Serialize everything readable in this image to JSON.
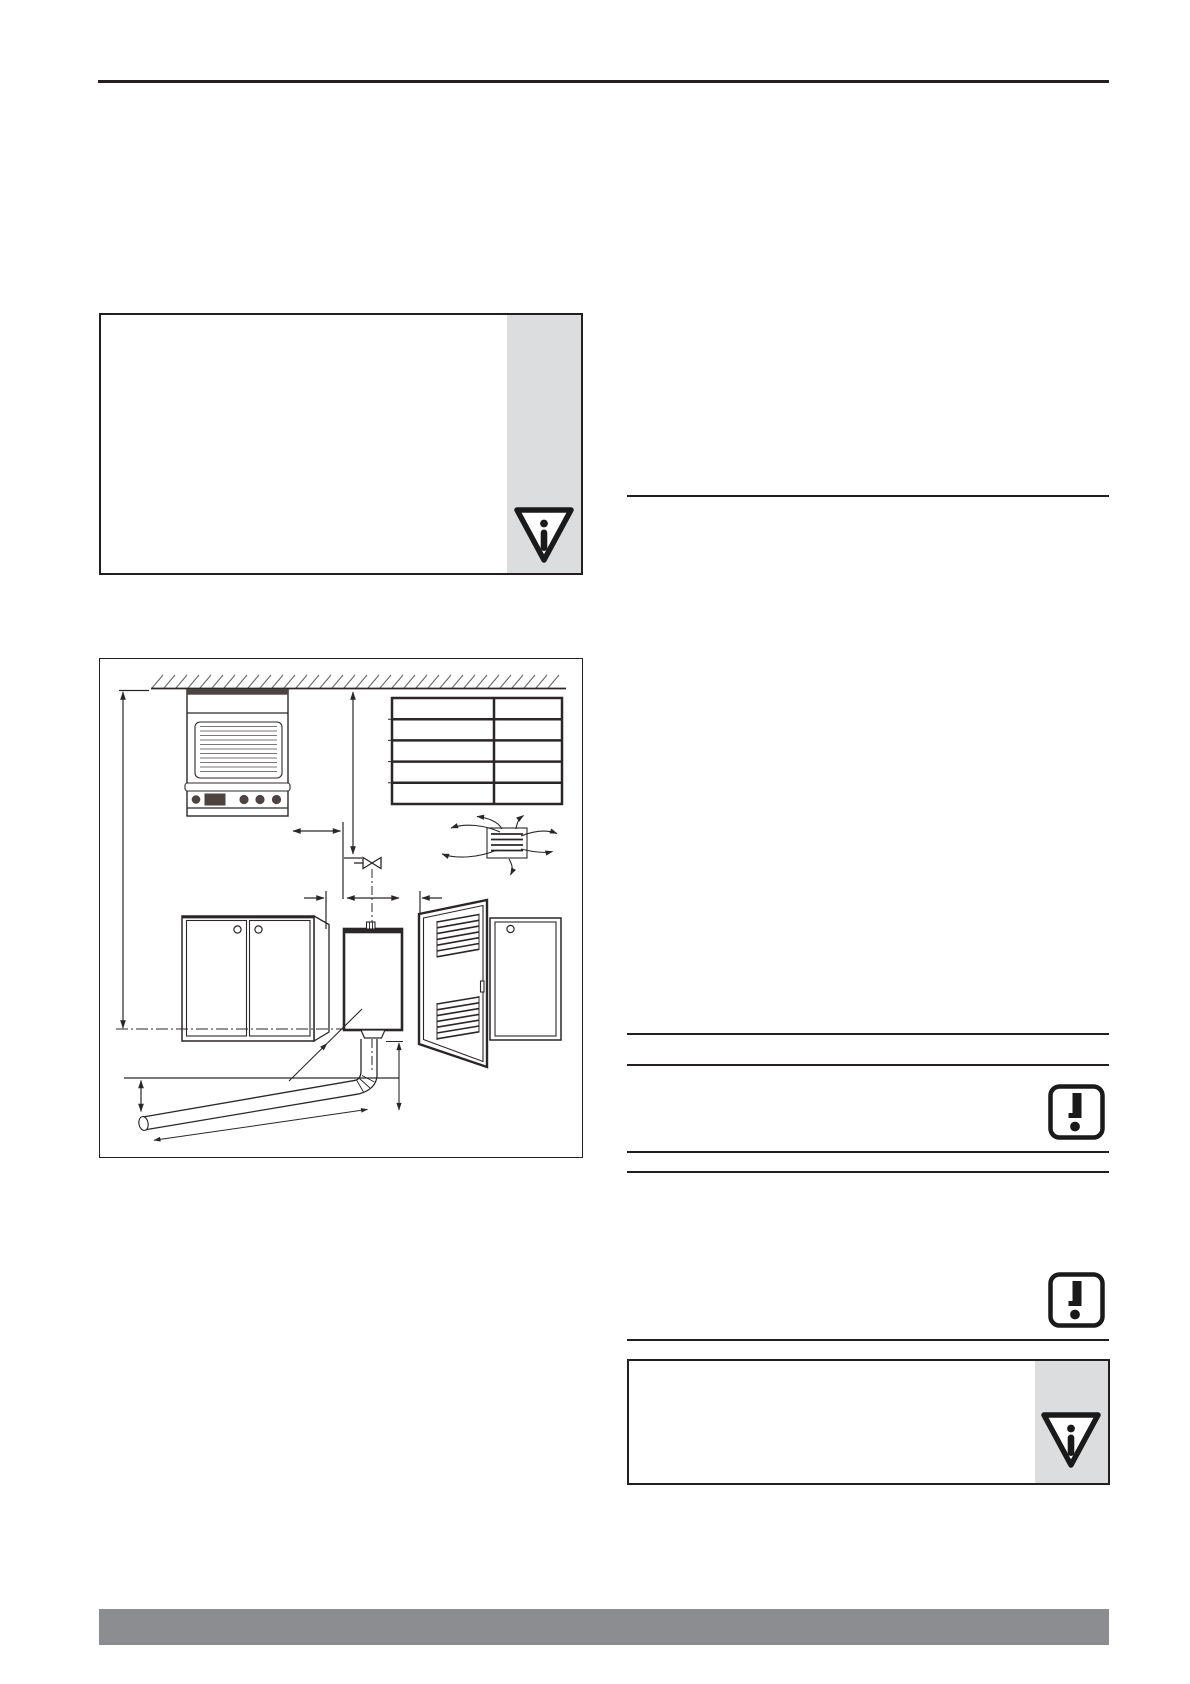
{
  "page": {
    "kind": "installation-manual-page",
    "visible_text": ""
  },
  "colors": {
    "paper": "#ffffff",
    "rule": "#231f20",
    "line_art": "#2b2728",
    "dark_fill": "#4d4341",
    "hatch": "#6b6663",
    "note_sidebar": "#dcddde",
    "footer_bar": "#8b8d90"
  },
  "icons": {
    "info_triangle": {
      "name": "info-triangle-icon",
      "glyph": "i"
    },
    "warning_square": {
      "name": "warning-exclamation-icon",
      "glyph": "!"
    }
  },
  "figure": {
    "elements": [
      "ceiling-hatching",
      "wall-mounted-appliance-with-grille",
      "ventilation-louvre-grid",
      "air-vent-grille-with-airflow-arrows",
      "gas-valve-symbol",
      "kitchen-cupboard-left",
      "water-heater-front-view",
      "open-louvred-door",
      "kitchen-cupboard-right",
      "flue-pipe-with-bend",
      "dimension-lines"
    ]
  }
}
